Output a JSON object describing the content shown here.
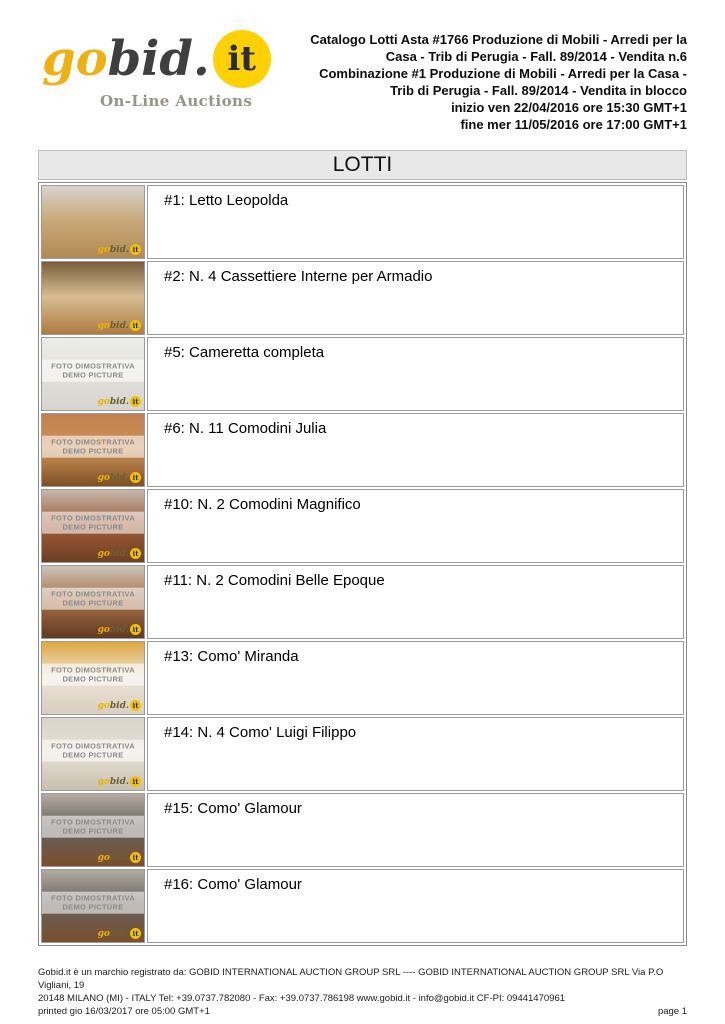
{
  "logo": {
    "go": "go",
    "bid": "bid.",
    "it": "it",
    "tagline": "On-Line Auctions",
    "yellow": "#FFD100",
    "amber": "#EFB012",
    "dark": "#3F3F3F"
  },
  "header": {
    "lines": [
      "Catalogo Lotti Asta #1766 Produzione di Mobili - Arredi per la",
      "Casa - Trib di Perugia - Fall. 89/2014 - Vendita n.6",
      "Combinazione #1 Produzione di Mobili - Arredi per la Casa -",
      "Trib di Perugia - Fall. 89/2014 - Vendita in blocco",
      "inizio ven 22/04/2016 ore 15:30 GMT+1",
      "fine mer 11/05/2016 ore 17:00 GMT+1"
    ]
  },
  "section_title": "LOTTI",
  "placeholder": {
    "line1": "FOTO DIMOSTRATIVA",
    "line2": "DEMO PICTURE"
  },
  "watermark": {
    "go": "go",
    "bid": "bid.",
    "it": "it"
  },
  "lots": [
    {
      "title": "#1: Letto Leopolda",
      "thumb": {
        "placeholder": false,
        "colors": [
          "#d7d4cf",
          "#c9a878",
          "#b08a55"
        ]
      }
    },
    {
      "title": "#2: N. 4 Cassettiere Interne per Armadio",
      "thumb": {
        "placeholder": false,
        "colors": [
          "#7a5c3c",
          "#d7bd92",
          "#ae7c41"
        ]
      }
    },
    {
      "title": "#5: Cameretta completa",
      "thumb": {
        "placeholder": true,
        "colors": [
          "#ececea",
          "#e2e1dd",
          "#d6d4cf"
        ]
      }
    },
    {
      "title": "#6: N. 11 Comodini Julia",
      "thumb": {
        "placeholder": true,
        "colors": [
          "#c08050",
          "#cf9258",
          "#7e5026"
        ]
      }
    },
    {
      "title": "#10: N. 2 Comodini Magnifico",
      "thumb": {
        "placeholder": true,
        "colors": [
          "#c4b8ab",
          "#a05c3a",
          "#6e3f24"
        ]
      }
    },
    {
      "title": "#11: N. 2 Comodini Belle Epoque",
      "thumb": {
        "placeholder": true,
        "colors": [
          "#ccc4bb",
          "#a86f47",
          "#5f3a22"
        ]
      }
    },
    {
      "title": "#13: Como' Miranda",
      "thumb": {
        "placeholder": true,
        "colors": [
          "#dfa73e",
          "#ece4d8",
          "#d8cfc0"
        ]
      }
    },
    {
      "title": "#14: N. 4 Como' Luigi Filippo",
      "thumb": {
        "placeholder": true,
        "colors": [
          "#d9d3c9",
          "#e7e0d5",
          "#c9c0b0"
        ]
      }
    },
    {
      "title": "#15: Como' Glamour",
      "thumb": {
        "placeholder": true,
        "colors": [
          "#b4aca2",
          "#64605c",
          "#7b4f2e"
        ]
      }
    },
    {
      "title": "#16: Como' Glamour",
      "thumb": {
        "placeholder": true,
        "colors": [
          "#b4aca2",
          "#64605c",
          "#7b4f2e"
        ]
      }
    }
  ],
  "footer": {
    "line1": "Gobid.it è un marchio registrato da:  GOBID INTERNATIONAL AUCTION GROUP SRL  ---- GOBID INTERNATIONAL AUCTION GROUP SRL   Via P.O Vigliani, 19",
    "line2": "20148 MILANO (MI) - ITALY  Tel: +39.0737.782080 - Fax: +39.0737.786198  www.gobid.it - info@gobid.it  CF-PI: 09441470961",
    "printed": "printed gio 16/03/2017 ore 05:00 GMT+1",
    "page": "page 1"
  }
}
